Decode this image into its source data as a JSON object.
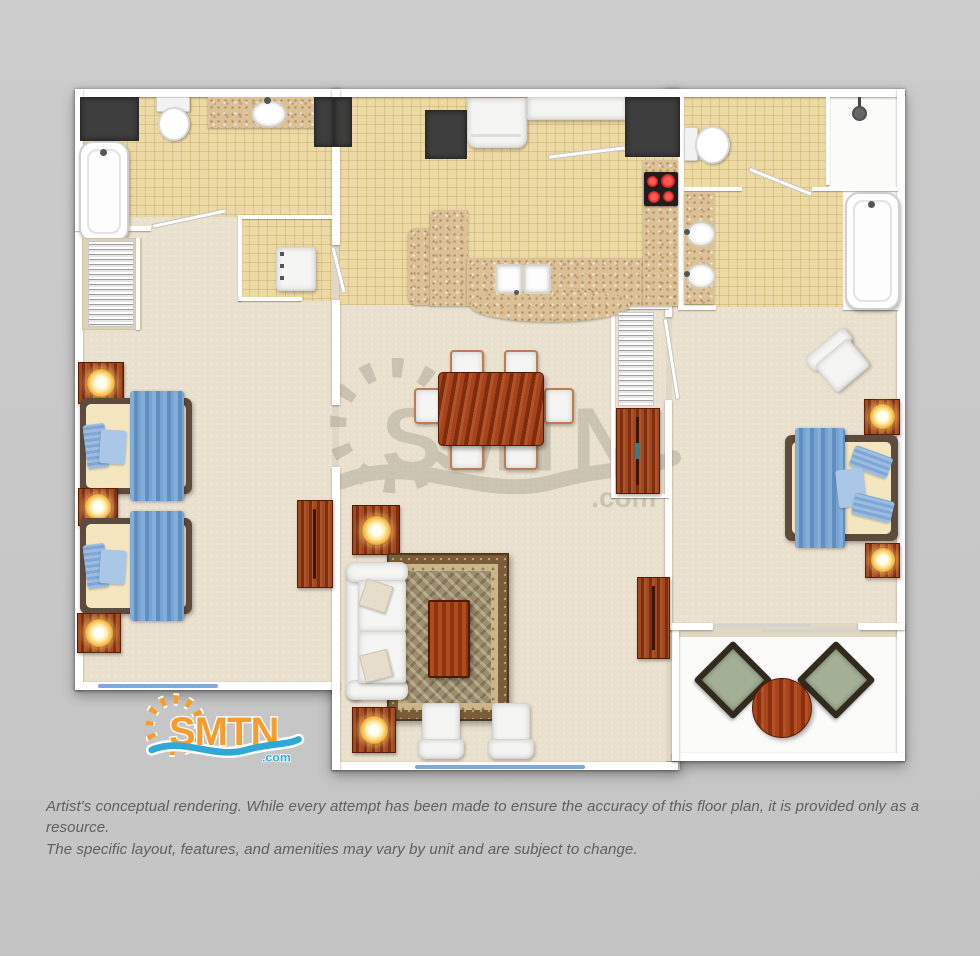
{
  "brand": {
    "name": "SMTN",
    "tld": ".com"
  },
  "watermark": {
    "name": "SMTN",
    "tld": ".com"
  },
  "disclaimer": {
    "line1": "Artist's conceptual rendering. While every attempt has been made to ensure the accuracy of this floor plan, it is provided only as a resource.",
    "line2": "The specific layout, features, and amenities may vary by unit and are subject to change."
  },
  "palette": {
    "background": "#c8c8c8",
    "wall": "#ffffff",
    "tile_floor": "#ecd9a4",
    "carpet_floor": "#e9e0cd",
    "granite_counter": "#dcc096",
    "dark_cabinet": "#3e3e3e",
    "wood": "#9a4420",
    "bed_blue": "#6f9dcb",
    "lamp_glow": "#ffd96a",
    "window_blue": "#82a7d8",
    "rug_red": "#b04a1e",
    "balcony_chair": "#a3b096",
    "logo_orange": "#f49d2e",
    "logo_blue": "#2fa8d5"
  }
}
